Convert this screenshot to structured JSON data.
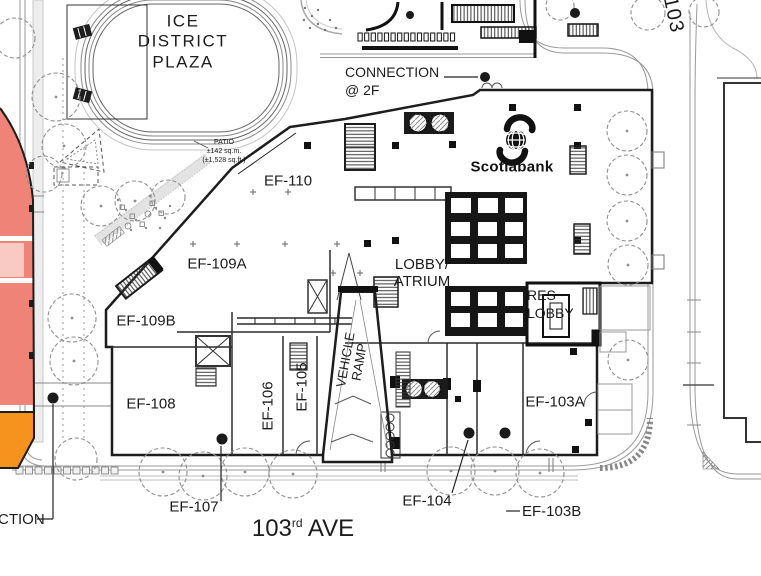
{
  "plan": {
    "plaza_title": "ICE\nDISTRICT\nPLAZA",
    "patio_note": "PATIO\n±142 sq.m.\n(±1,528 sq.ft.)",
    "connection_note": "CONNECTION\n@ 2F",
    "connection_partial": "CTION",
    "lobby_atrium": "LOBBY/\nATRIUM",
    "res_lobby": "RES\nLOBBY",
    "vehicle_ramp": "VEHICLE\nRAMP"
  },
  "rooms": {
    "ef110": "EF-110",
    "ef109a": "EF-109A",
    "ef109b": "EF-109B",
    "ef108": "EF-108",
    "ef107": "EF-107",
    "ef106": "EF-106",
    "ef105": "EF-105",
    "ef104": "EF-104",
    "ef103a": "EF-103A",
    "ef103b": "EF-103B"
  },
  "streets": {
    "ave_number": "103",
    "ave_ordinal": "rd",
    "ave_name": "AVE",
    "cross_street_number": "103"
  },
  "tenant": {
    "name": "Scotiabank",
    "brand_color": "#111111"
  },
  "colors": {
    "building_red": "#EF8377",
    "building_pink": "#F9CAC3",
    "building_orange": "#F6921E"
  }
}
